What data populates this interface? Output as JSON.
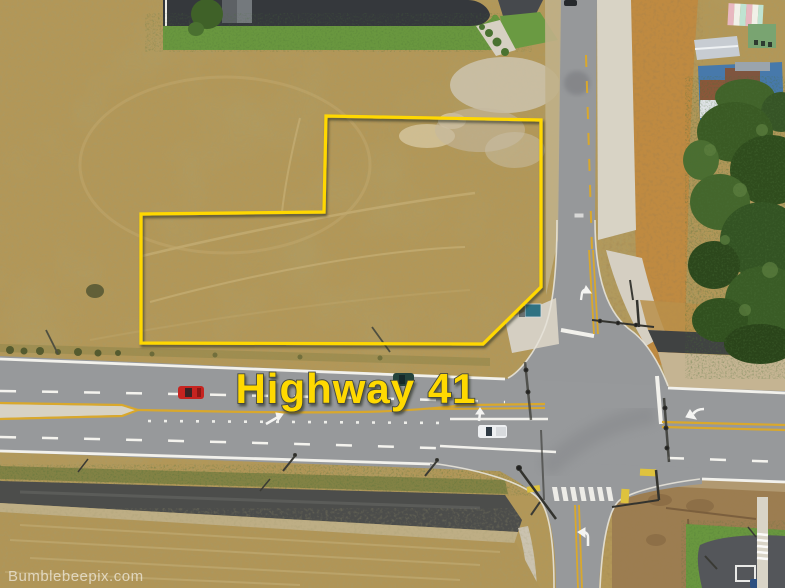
{
  "title": "Aerial land-for-sale photo",
  "annotations": {
    "road_label": "Highway 41",
    "road_label_color": "#ffd903",
    "watermark": "Bumblebeepix.com",
    "watermark_color": "rgba(255,255,255,0.6)",
    "boundary_points": "326,116 541,120 541,287 483,344 141,343 141,214 324,212",
    "boundary_color": "#FFD800"
  },
  "scene": {
    "description": "Drone view of a vacant dry-grass parcel outlined in yellow at the northwest corner of a signalized four-way intersection on Highway 41; dirt lot and new curbs southeast, evergreen trees and metal-roof buildings east, subdivision lot north.",
    "palette": {
      "dry_grass": "#b29758",
      "scrub_orange": "#bf8a41",
      "asphalt": "#97999b",
      "fresh_asphalt": "#4c4d4b",
      "concrete": "#d8d3c5",
      "lawn_green": "#69973f",
      "tree_green": "#33531f",
      "graded_dirt": "#9c7d51",
      "lane_yellow": "#d9a82c",
      "lane_white": "#f2f1ec"
    },
    "vehicles": [
      "red car westbound on Highway 41",
      "dark green car eastbound near label",
      "white pickup eastbound at intersection",
      "dark car at top of north road",
      "dark blue car at bottom-right driveway"
    ]
  }
}
